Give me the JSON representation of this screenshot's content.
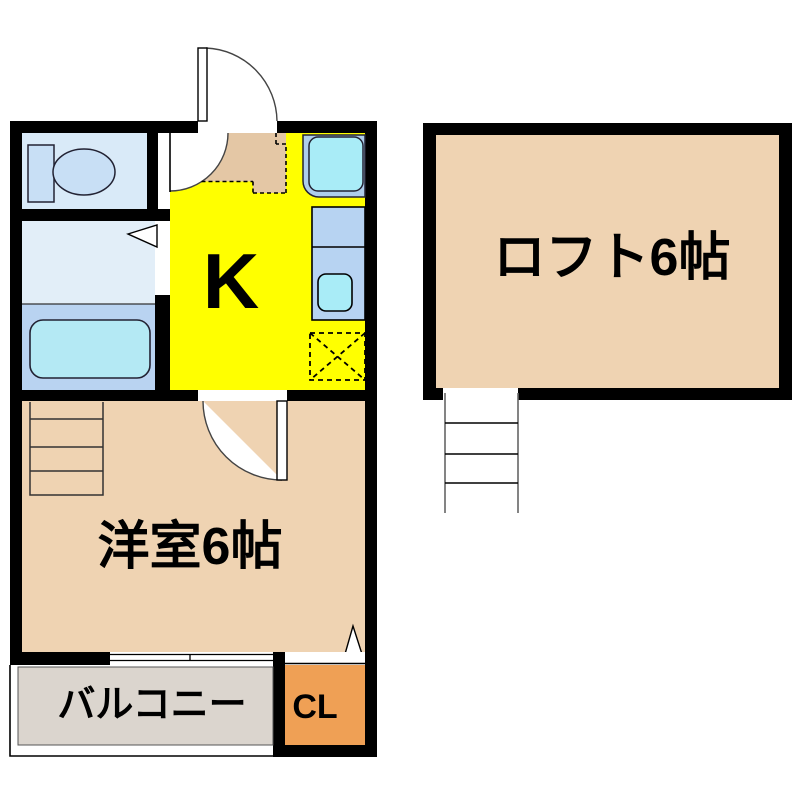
{
  "plan": {
    "title": "1K apartment floor plan with loft",
    "floor1": {
      "kitchen": {
        "label": "K"
      },
      "western_room": {
        "label": "洋室6帖"
      },
      "balcony": {
        "label": "バルコニー"
      },
      "closet": {
        "label": "CL"
      }
    },
    "floor2": {
      "loft": {
        "label": "ロフト6帖"
      }
    },
    "fixtures": [
      "toilet",
      "washroom-door",
      "bathtub",
      "kitchen-sink",
      "kitchen-counter",
      "refrigerator-space",
      "entrance-door",
      "room-door",
      "hall-door",
      "loft-ladder",
      "room-ladder",
      "sliding-window",
      "closet-door"
    ]
  },
  "colors": {
    "wall": "#000000",
    "kitchen": "#ffff00",
    "room_tan": "#efd3b2",
    "genkan": "#e4c7a5",
    "toilet_room": "#d9eaf8",
    "washroom": "#e2eef8",
    "bathroom": "#b9d3f1",
    "water_cyan": "#b4e9f4",
    "fixture_blue": "#c8dff5",
    "sink_base": "#aecdeb",
    "sink_cyan": "#a9ecf7",
    "counter": "#b7d3f2",
    "balcony": "#dbd5ce",
    "closet": "#efa055",
    "arc_line": "#444444"
  }
}
